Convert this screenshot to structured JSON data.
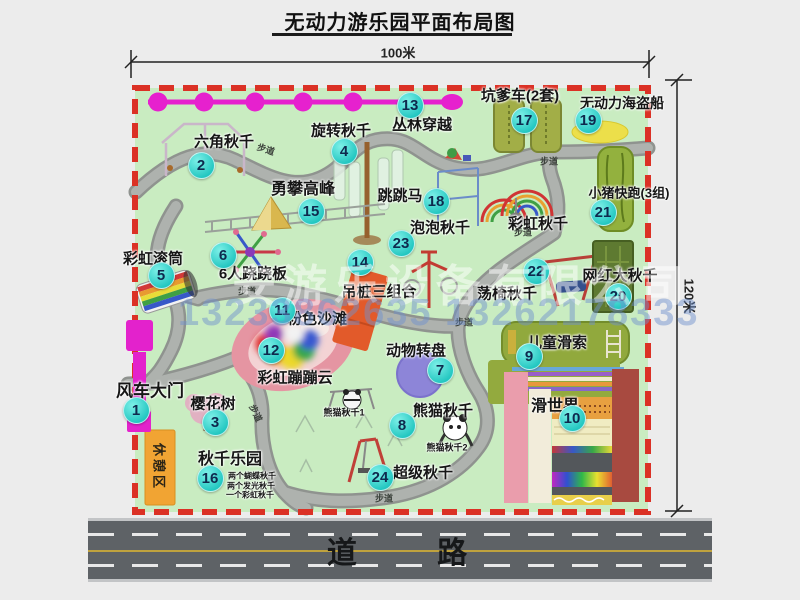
{
  "title": "无动力游乐园平面布局图",
  "dim_top": "100米",
  "dim_right": "120米",
  "road_label": "道 路",
  "rest_area_label": "休憩区",
  "watermark": {
    "company": "安游乐设备有限公司",
    "phone": "13233862635 13262178333"
  },
  "colors": {
    "park_green": "#c9ecc1",
    "border_red": "#db3125",
    "badge_cyan": "#21c6c0",
    "zipline_magenta": "#e621ce",
    "road_gray": "#5e6266",
    "rest_orange": "#f1a433"
  },
  "facilities": [
    {
      "n": "1",
      "t": "风车大门",
      "bx": 136,
      "by": 410,
      "lx": 150,
      "ly": 389,
      "fs": 17
    },
    {
      "n": "2",
      "t": "六角秋千",
      "bx": 201,
      "by": 165,
      "lx": 224,
      "ly": 141
    },
    {
      "n": "3",
      "t": "樱花树",
      "bx": 215,
      "by": 422,
      "lx": 213,
      "ly": 403
    },
    {
      "n": "4",
      "t": "旋转秋千",
      "bx": 344,
      "by": 151,
      "lx": 341,
      "ly": 130
    },
    {
      "n": "5",
      "t": "彩虹滚筒",
      "bx": 161,
      "by": 275,
      "lx": 153,
      "ly": 258
    },
    {
      "n": "6",
      "t": "6人跷跷板",
      "bx": 223,
      "by": 255,
      "lx": 253,
      "ly": 273
    },
    {
      "n": "7",
      "t": "动物转盘",
      "bx": 440,
      "by": 370,
      "lx": 416,
      "ly": 350
    },
    {
      "n": "8",
      "t": "熊猫秋千",
      "bx": 402,
      "by": 425,
      "lx": 443,
      "ly": 410
    },
    {
      "n": "9",
      "t": "儿童滑索",
      "bx": 529,
      "by": 356,
      "lx": 557,
      "ly": 342
    },
    {
      "n": "10",
      "t": "滑世界",
      "bx": 572,
      "by": 418,
      "lx": 555,
      "ly": 404,
      "fs": 16
    },
    {
      "n": "11",
      "t": "粉色沙滩",
      "bx": 282,
      "by": 310,
      "lx": 317,
      "ly": 318
    },
    {
      "n": "12",
      "t": "彩虹蹦蹦云",
      "bx": 271,
      "by": 350,
      "lx": 295,
      "ly": 377
    },
    {
      "n": "13",
      "t": "丛林穿越",
      "bx": 410,
      "by": 105,
      "lx": 422,
      "ly": 124
    },
    {
      "n": "14",
      "t": "吊桩三组合",
      "bx": 360,
      "by": 262,
      "lx": 379,
      "ly": 291
    },
    {
      "n": "15",
      "t": "勇攀高峰",
      "bx": 311,
      "by": 211,
      "lx": 303,
      "ly": 187,
      "fs": 16
    },
    {
      "n": "16",
      "t": "秋千乐园",
      "bx": 210,
      "by": 478,
      "lx": 230,
      "ly": 457,
      "fs": 16
    },
    {
      "n": "17",
      "t": "坑爹车(2套)",
      "bx": 524,
      "by": 120,
      "lx": 520,
      "ly": 95
    },
    {
      "n": "18",
      "t": "跳跳马",
      "bx": 436,
      "by": 201,
      "lx": 400,
      "ly": 195
    },
    {
      "n": "19",
      "t": "无动力海盗船",
      "bx": 588,
      "by": 120,
      "lx": 622,
      "ly": 103,
      "fs": 14
    },
    {
      "n": "20",
      "t": "网红大秋千",
      "bx": 618,
      "by": 296,
      "lx": 620,
      "ly": 275
    },
    {
      "n": "21",
      "t": "小猪快跑(3组)",
      "bx": 603,
      "by": 212,
      "lx": 629,
      "ly": 192,
      "fs": 13
    },
    {
      "n": "22",
      "t": "荡椅秋千",
      "bx": 536,
      "by": 271,
      "lx": 507,
      "ly": 293
    },
    {
      "n": "23",
      "t": "泡泡秋千",
      "bx": 401,
      "by": 243,
      "lx": 440,
      "ly": 227
    },
    {
      "n": "24",
      "t": "超级秋千",
      "bx": 380,
      "by": 477,
      "lx": 423,
      "ly": 472
    },
    {
      "t": "彩虹秋千",
      "lx": 538,
      "ly": 223
    }
  ],
  "small_labels": [
    {
      "text": "熊猫秋千1",
      "x": 344,
      "y": 412,
      "fs": 9
    },
    {
      "text": "熊猫秋千2",
      "x": 447,
      "y": 447,
      "fs": 9
    },
    {
      "text": "两个蝴蝶秋千",
      "x": 252,
      "y": 476,
      "fs": 8
    },
    {
      "text": "两个发光秋千",
      "x": 251,
      "y": 486,
      "fs": 8
    },
    {
      "text": "一个彩虹秋千",
      "x": 250,
      "y": 495,
      "fs": 8
    }
  ],
  "path_labels": [
    {
      "text": "步道",
      "x": 266,
      "y": 149,
      "rot": 18
    },
    {
      "text": "步道",
      "x": 549,
      "y": 161,
      "rot": 0
    },
    {
      "text": "步道",
      "x": 247,
      "y": 291,
      "rot": 0
    },
    {
      "text": "步道",
      "x": 523,
      "y": 232,
      "rot": 0
    },
    {
      "text": "步道",
      "x": 464,
      "y": 322,
      "rot": 0
    },
    {
      "text": "步道",
      "x": 256,
      "y": 413,
      "rot": 65
    },
    {
      "text": "步道",
      "x": 384,
      "y": 498,
      "rot": 0
    }
  ]
}
